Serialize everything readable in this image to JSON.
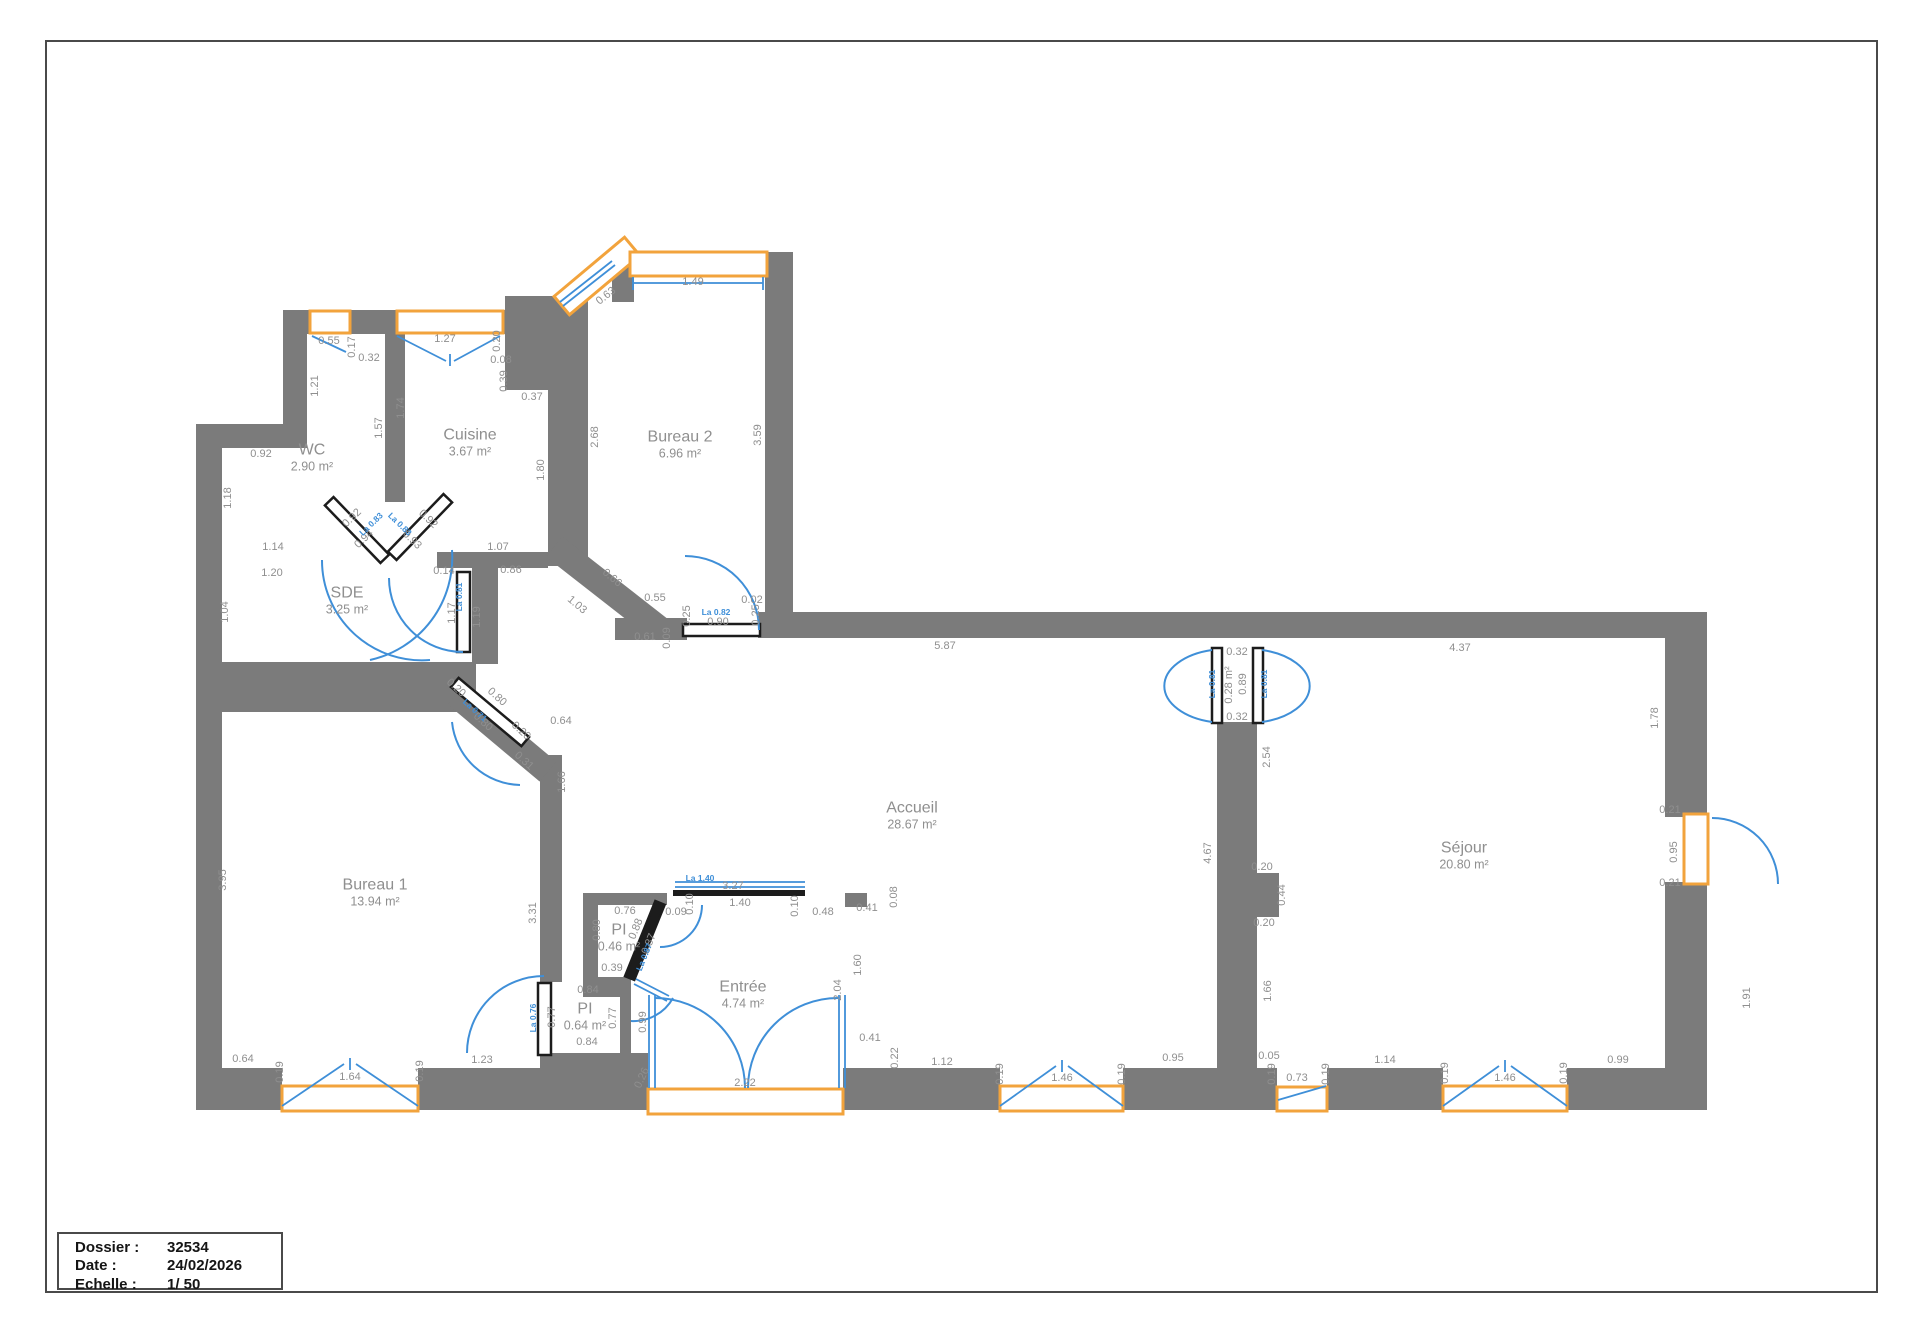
{
  "colors": {
    "wall": "#7b7b7b",
    "window": "#f2a33c",
    "door": "#3f8fd8",
    "dim": "#8f8f8f",
    "border": "#4a4a4a"
  },
  "title_block": {
    "rows": [
      {
        "label": "Dossier :",
        "value": "32534"
      },
      {
        "label": "Date :",
        "value": "24/02/2026"
      },
      {
        "label": "Echelle :",
        "value": "1/ 50"
      }
    ]
  },
  "rooms": [
    {
      "name": "WC",
      "area": "2.90 m²",
      "x": 312,
      "y": 458
    },
    {
      "name": "Cuisine",
      "area": "3.67 m²",
      "x": 470,
      "y": 443
    },
    {
      "name": "Bureau 2",
      "area": "6.96 m²",
      "x": 680,
      "y": 445
    },
    {
      "name": "SDE",
      "area": "3.25 m²",
      "x": 347,
      "y": 601
    },
    {
      "name": "Bureau 1",
      "area": "13.94 m²",
      "x": 375,
      "y": 893
    },
    {
      "name": "Accueil",
      "area": "28.67 m²",
      "x": 912,
      "y": 816
    },
    {
      "name": "PI",
      "area": "0.46 m²",
      "x": 619,
      "y": 938
    },
    {
      "name": "PI",
      "area": "0.64 m²",
      "x": 585,
      "y": 1017
    },
    {
      "name": "Entrée",
      "area": "4.74 m²",
      "x": 743,
      "y": 995
    },
    {
      "name": "Séjour",
      "area": "20.80 m²",
      "x": 1464,
      "y": 856
    }
  ],
  "dims": [
    [
      "0.55",
      329,
      341,
      0
    ],
    [
      "0.17",
      352,
      347,
      90
    ],
    [
      "0.32",
      369,
      358,
      0
    ],
    [
      "1.21",
      315,
      386,
      90
    ],
    [
      "0.92",
      261,
      454,
      0
    ],
    [
      "1.57",
      379,
      428,
      90
    ],
    [
      "1.74",
      401,
      408,
      90
    ],
    [
      "1.27",
      445,
      339,
      0
    ],
    [
      "0.20",
      497,
      341,
      90
    ],
    [
      "0.08",
      501,
      360,
      0
    ],
    [
      "0.39",
      504,
      381,
      90
    ],
    [
      "0.37",
      532,
      397,
      0
    ],
    [
      "1.18",
      228,
      498,
      90
    ],
    [
      "1.14",
      273,
      547,
      0
    ],
    [
      "1.20",
      272,
      573,
      0
    ],
    [
      "1.04",
      225,
      612,
      90
    ],
    [
      "0.92",
      352,
      518,
      44
    ],
    [
      "0.94",
      364,
      539,
      44
    ],
    [
      "0.92",
      428,
      519,
      -44
    ],
    [
      "0.93",
      412,
      540,
      -44
    ],
    [
      "0.14",
      444,
      571,
      0
    ],
    [
      "1.17",
      452,
      613,
      90
    ],
    [
      "1.19",
      477,
      617,
      90
    ],
    [
      "1.07",
      498,
      547,
      0
    ],
    [
      "0.86",
      511,
      570,
      0
    ],
    [
      "1.80",
      541,
      470,
      90
    ],
    [
      "2.68",
      595,
      437,
      90
    ],
    [
      "3.59",
      758,
      435,
      90
    ],
    [
      "0.63",
      606,
      296,
      38
    ],
    [
      "1.49",
      693,
      282,
      0
    ],
    [
      "1.03",
      577,
      605,
      -40
    ],
    [
      "0.66",
      612,
      578,
      -40
    ],
    [
      "0.55",
      655,
      598,
      0
    ],
    [
      "0.25",
      687,
      616,
      90
    ],
    [
      "0.61",
      645,
      637,
      0
    ],
    [
      "0.09",
      667,
      638,
      90
    ],
    [
      "0.90",
      718,
      622,
      0
    ],
    [
      "0.02",
      752,
      600,
      0
    ],
    [
      "0.25",
      756,
      615,
      90
    ],
    [
      "5.87",
      945,
      646,
      0
    ],
    [
      "3.95",
      223,
      880,
      90
    ],
    [
      "0.20",
      456,
      688,
      -42
    ],
    [
      "0.80",
      497,
      697,
      -42
    ],
    [
      "0.80",
      483,
      722,
      -42
    ],
    [
      "0.20",
      521,
      731,
      -42
    ],
    [
      "0.31",
      524,
      761,
      -42
    ],
    [
      "0.64",
      561,
      721,
      0
    ],
    [
      "1.66",
      562,
      782,
      90
    ],
    [
      "3.31",
      533,
      913,
      90
    ],
    [
      "0.76",
      625,
      911,
      0
    ],
    [
      "0.80",
      597,
      930,
      90
    ],
    [
      "0.39",
      612,
      968,
      0
    ],
    [
      "0.88",
      636,
      929,
      68
    ],
    [
      "0.87",
      649,
      944,
      68
    ],
    [
      "0.09",
      676,
      912,
      0
    ],
    [
      "0.10",
      690,
      904,
      90
    ],
    [
      "1.40",
      740,
      903,
      0
    ],
    [
      "0.10",
      795,
      906,
      90
    ],
    [
      "0.48",
      823,
      912,
      0
    ],
    [
      "0.41",
      867,
      908,
      0
    ],
    [
      "3.27",
      733,
      886,
      0
    ],
    [
      "0.08",
      894,
      897,
      90
    ],
    [
      "1.60",
      858,
      965,
      90
    ],
    [
      "2.04",
      838,
      990,
      90
    ],
    [
      "0.41",
      870,
      1038,
      0
    ],
    [
      "0.99",
      643,
      1022,
      90
    ],
    [
      "0.26",
      642,
      1078,
      65
    ],
    [
      "2.22",
      745,
      1083,
      0
    ],
    [
      "0.84",
      588,
      990,
      0
    ],
    [
      "0.77",
      613,
      1018,
      90
    ],
    [
      "0.84",
      587,
      1042,
      0
    ],
    [
      "0.77",
      552,
      1017,
      90
    ],
    [
      "1.23",
      482,
      1060,
      0
    ],
    [
      "0.64",
      243,
      1059,
      0
    ],
    [
      "0.19",
      280,
      1072,
      90
    ],
    [
      "1.64",
      350,
      1077,
      0
    ],
    [
      "0.19",
      420,
      1071,
      90
    ],
    [
      "0.22",
      895,
      1058,
      90
    ],
    [
      "1.12",
      942,
      1062,
      0
    ],
    [
      "0.19",
      1000,
      1074,
      90
    ],
    [
      "1.46",
      1062,
      1078,
      0
    ],
    [
      "0.19",
      1122,
      1074,
      90
    ],
    [
      "0.95",
      1173,
      1058,
      0
    ],
    [
      "4.67",
      1208,
      853,
      90
    ],
    [
      "0.32",
      1237,
      652,
      0
    ],
    [
      "0.28 m²",
      1229,
      685,
      90
    ],
    [
      "0.89",
      1243,
      684,
      90
    ],
    [
      "0.32",
      1237,
      717,
      0
    ],
    [
      "2.54",
      1267,
      757,
      90
    ],
    [
      "4.37",
      1460,
      648,
      0
    ],
    [
      "1.78",
      1655,
      718,
      90
    ],
    [
      "0.21",
      1670,
      810,
      0
    ],
    [
      "0.95",
      1674,
      852,
      90
    ],
    [
      "0.21",
      1670,
      883,
      0
    ],
    [
      "1.91",
      1747,
      998,
      90
    ],
    [
      "0.20",
      1262,
      867,
      0
    ],
    [
      "0.44",
      1282,
      895,
      90
    ],
    [
      "0.20",
      1264,
      923,
      0
    ],
    [
      "1.66",
      1268,
      991,
      90
    ],
    [
      "0.05",
      1269,
      1056,
      0
    ],
    [
      "0.19",
      1272,
      1074,
      90
    ],
    [
      "0.73",
      1297,
      1078,
      0
    ],
    [
      "0.19",
      1326,
      1074,
      90
    ],
    [
      "1.14",
      1385,
      1060,
      0
    ],
    [
      "0.19",
      1445,
      1073,
      90
    ],
    [
      "1.46",
      1505,
      1078,
      0
    ],
    [
      "0.19",
      1564,
      1073,
      90
    ],
    [
      "0.99",
      1618,
      1060,
      0
    ]
  ],
  "blue_labels": [
    [
      "La 0.83",
      371,
      524,
      44
    ],
    [
      "La 0.83",
      400,
      524,
      -44
    ],
    [
      "La 0.81",
      459,
      597,
      90
    ],
    [
      "La 0.71",
      475,
      710,
      -42
    ],
    [
      "La 0.82",
      716,
      612,
      0
    ],
    [
      "La 1.40",
      700,
      878,
      0
    ],
    [
      "La 0.87",
      644,
      957,
      68
    ],
    [
      "La 0.76",
      533,
      1018,
      90
    ],
    [
      "La 0.81",
      1212,
      684,
      90
    ],
    [
      "La 0.81",
      1264,
      684,
      90
    ]
  ]
}
